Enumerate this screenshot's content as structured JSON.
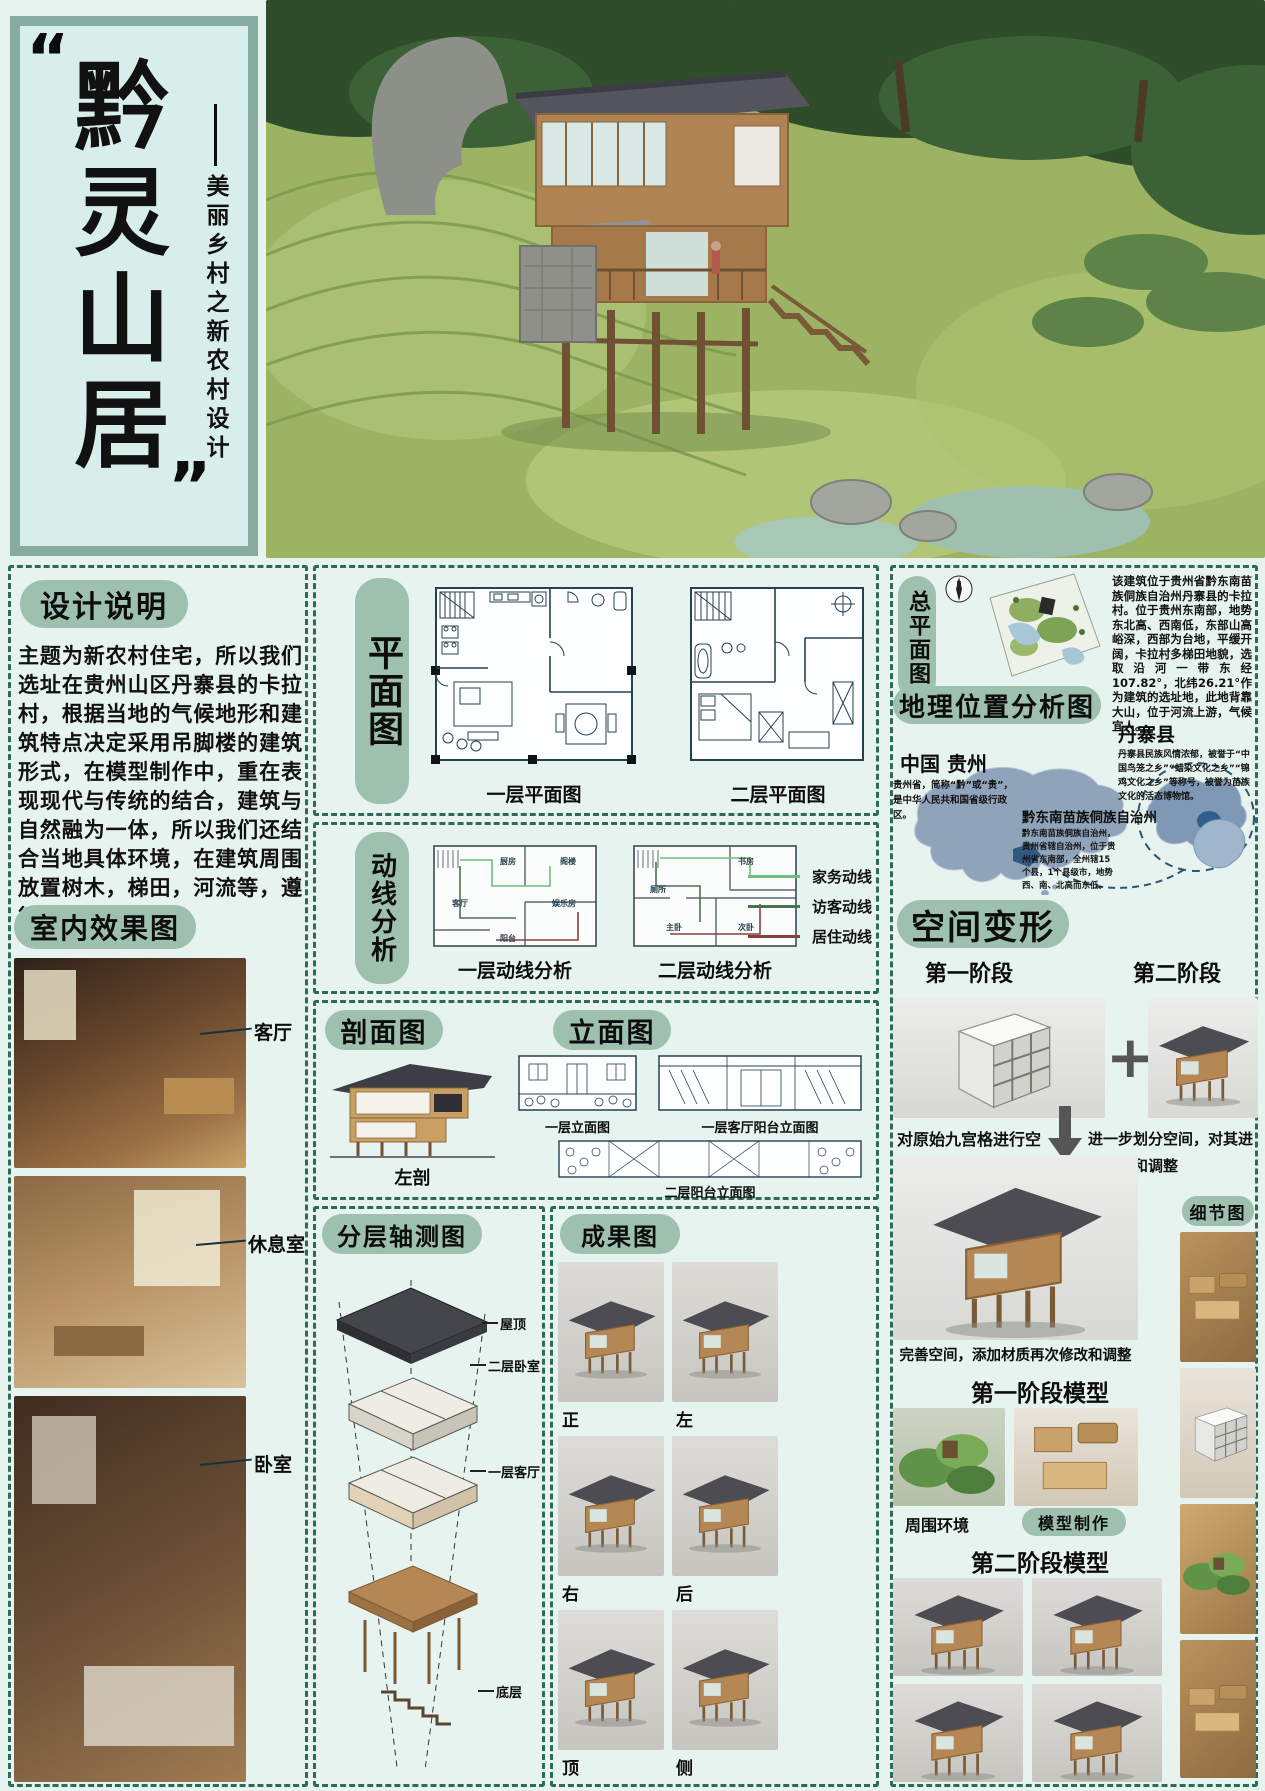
{
  "title_block": {
    "quote_open": "“",
    "quote_close": "”",
    "title": "黔灵山居",
    "dash": "——",
    "subtitle": "美丽乡村之新农村设计"
  },
  "design_notes": {
    "header": "设计说明",
    "body": "主题为新农村住宅，所以我们选址在贵州山区丹寨县的卡拉村，根据当地的气候地形和建筑特点决定采用吊脚楼的建筑形式，在模型制作中，重在表现现代与传统的结合，建筑与自然融为一体，所以我们还结合当地具体环境，在建筑周围放置树木，梯田，河流等，遵循因地制宜原则。"
  },
  "interior": {
    "header": "室内效果图",
    "labels": [
      "客厅",
      "休息室",
      "卧室"
    ]
  },
  "plans": {
    "pill": "平面图",
    "captions": [
      "一层平面图",
      "二层平面图"
    ]
  },
  "circulation": {
    "pill": "动线分析",
    "captions": [
      "一层动线分析",
      "二层动线分析"
    ],
    "room_labels_f1": [
      "厨房",
      "阁楼",
      "客厅",
      "娱乐房",
      "阳台"
    ],
    "room_labels_f2": [
      "书房",
      "厕所",
      "主卧",
      "次卧"
    ],
    "legend": [
      {
        "label": "家务动线",
        "color": "#6fbf7d"
      },
      {
        "label": "访客动线",
        "color": "#4c7152"
      },
      {
        "label": "居住动线",
        "color": "#8a3f3c"
      }
    ]
  },
  "section": {
    "pill": "剖面图",
    "caption": "左剖"
  },
  "elevation": {
    "pill": "立面图",
    "captions": [
      "一层立面图",
      "一层客厅阳台立面图",
      "二层阳台立面图"
    ]
  },
  "axon": {
    "pill": "分层轴测图",
    "labels": [
      "屋顶",
      "二层卧室",
      "一层客厅",
      "底层"
    ]
  },
  "results": {
    "pill": "成果图",
    "labels": [
      "正",
      "左",
      "右",
      "后",
      "顶",
      "侧"
    ]
  },
  "siteplan": {
    "pill": "总平面图",
    "body": "该建筑位于贵州省黔东南苗族侗族自治州丹寨县的卡拉村。位于贵州东南部，地势东北高、西南低，东部山高峪深，西部为台地，平缓开阔，卡拉村多梯田地貌，选取沿河一带东经107.82°，北纬26.21°作为建筑的选址地，此地背靠大山，位于河流上游，气候宜人。"
  },
  "geo": {
    "header": "地理位置分析图",
    "china_label": "中国 贵州",
    "china_desc": "贵州省，简称“黔”或“贵”，是中华人民共和国省级行政区。",
    "danzhai_label": "丹寨县",
    "danzhai_desc": "丹寨县民族风情浓郁，被誉于“中国鸟笼之乡”“蜡染文化之乡”“锦鸡文化之乡”等称号，被誉为苗族文化的活态博物馆。",
    "qdn_label": "黔东南苗族侗族自治州",
    "qdn_desc": "黔东南苗族侗族自治州，贵州省辖自治州，位于贵州省东南部，全州辖15个县，1个县级市，地势西、南、北高而东低。"
  },
  "transform": {
    "header": "空间变形",
    "stage1": "第一阶段",
    "stage2": "第二阶段",
    "plus": "+",
    "caption1": "对原始九宫格进行空间开放和封闭处理",
    "caption2": "进一步划分空间，对其进行修改和调整",
    "caption3": "完善空间，添加材质再次修改和调整"
  },
  "models": {
    "stage1_header": "第一阶段模型",
    "env_label": "周围环境",
    "make_label": "模型制作",
    "stage2_header": "第二阶段模型",
    "details_header": "细节图"
  }
}
